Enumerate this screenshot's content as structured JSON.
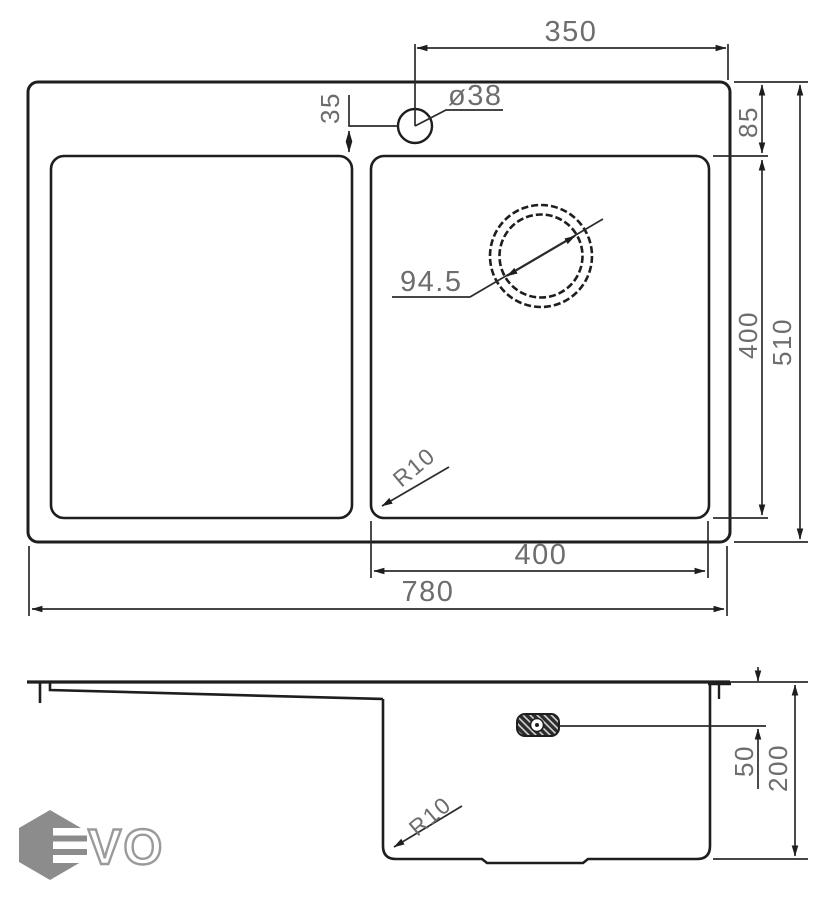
{
  "drawing_title": "EVO kitchen sink technical drawing",
  "colors": {
    "line": "#1e1e1e",
    "dim_text": "#6d6d6d",
    "logo_gray": "#8c8c8c"
  },
  "top_view": {
    "faucet_offset": "350",
    "faucet_hole_diameter": "ø38",
    "faucet_to_bowl": "35",
    "rim_to_bowl": "85",
    "bowl_length": "400",
    "overall_depth": "510",
    "drain_diameter": "94.5",
    "corner_radius": "R10",
    "bowl_width": "400",
    "overall_width": "780"
  },
  "side_view": {
    "rim_to_overflow": "50",
    "bowl_depth": "200",
    "corner_radius": "R10"
  },
  "logo": {
    "brand": "EVO",
    "vo": "VO"
  }
}
